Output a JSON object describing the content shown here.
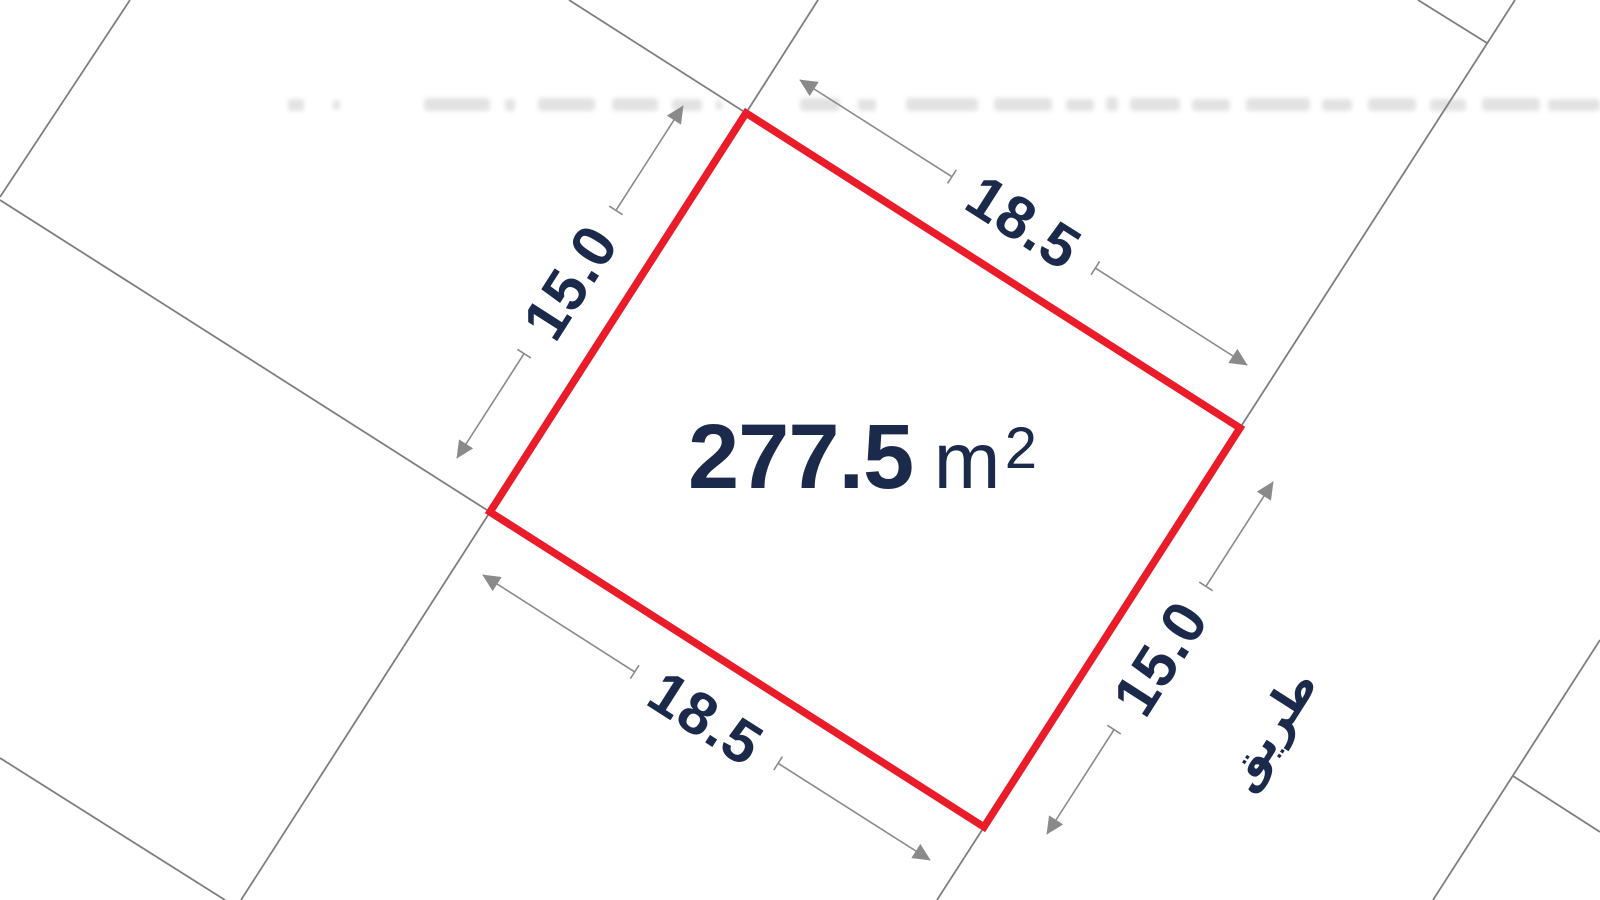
{
  "colors": {
    "plot_red": "#ea1c2a",
    "navy": "#1b2a4b",
    "parcel_gray": "#7f7f7f",
    "dim_gray": "#8a8a8a"
  },
  "plot": {
    "area_value": "277.5",
    "area_unit": "m",
    "area_superscript": "2"
  },
  "dimensions": {
    "top": "18.5",
    "bottom": "18.5",
    "left": "15.0",
    "right": "15.0"
  },
  "road": {
    "label": "طريق"
  }
}
